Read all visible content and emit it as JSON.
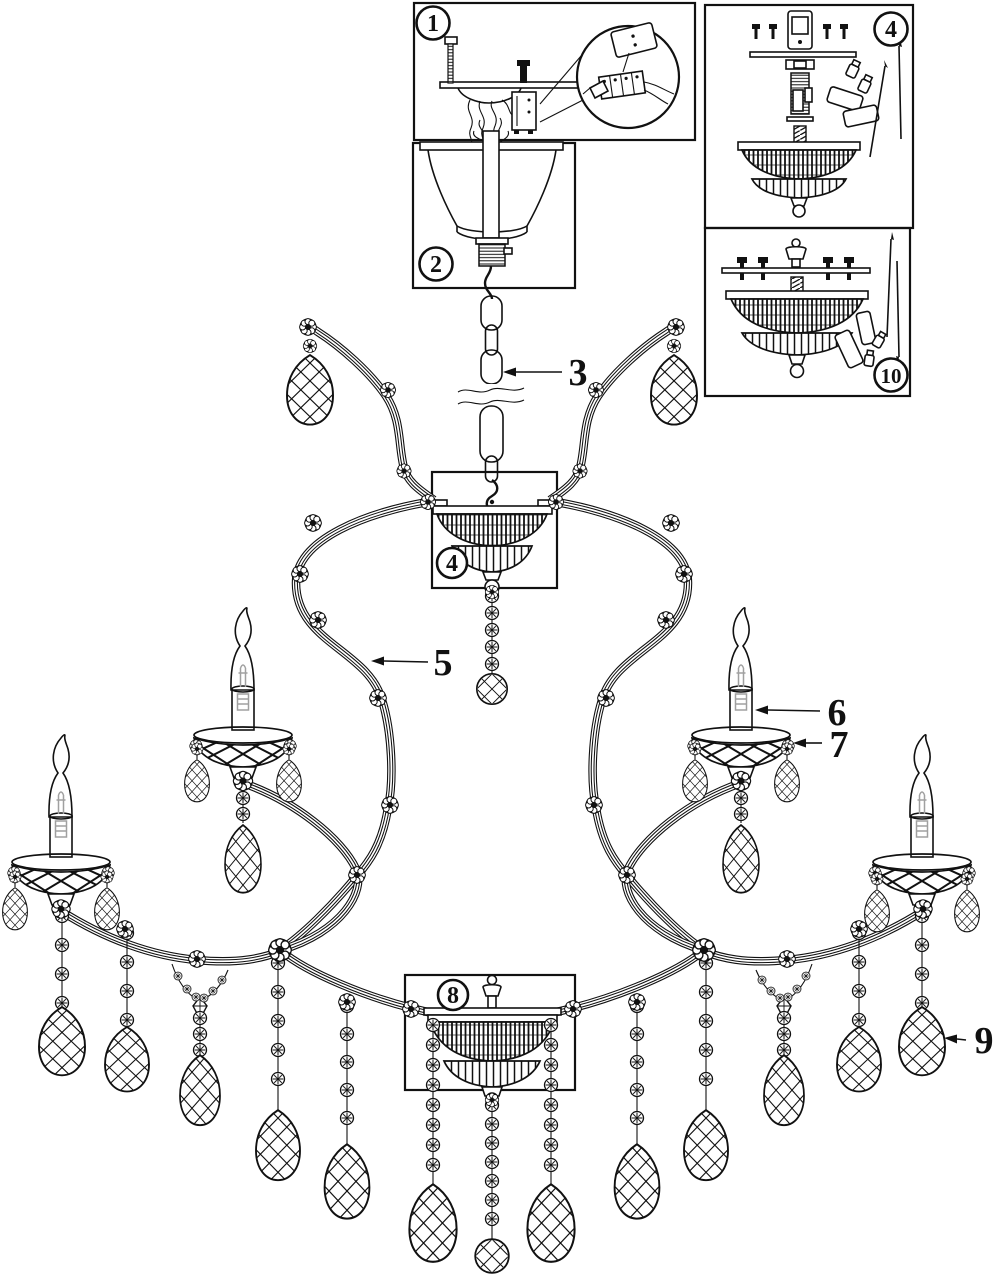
{
  "diagram": {
    "background_color": "#ffffff",
    "line_color": "#111111",
    "bulb_detail_color": "#a0a0a0",
    "callouts": {
      "c1": {
        "label": "1",
        "circled": true
      },
      "c2": {
        "label": "2",
        "circled": true
      },
      "c3": {
        "label": "3",
        "circled": false
      },
      "c4_panel": {
        "label": "4",
        "circled": true
      },
      "c4_bowl": {
        "label": "4",
        "circled": true
      },
      "c5": {
        "label": "5",
        "circled": false
      },
      "c6": {
        "label": "6",
        "circled": false
      },
      "c7": {
        "label": "7",
        "circled": false
      },
      "c8": {
        "label": "8",
        "circled": true
      },
      "c9": {
        "label": "9",
        "circled": false
      },
      "c10": {
        "label": "10",
        "circled": true
      }
    }
  }
}
